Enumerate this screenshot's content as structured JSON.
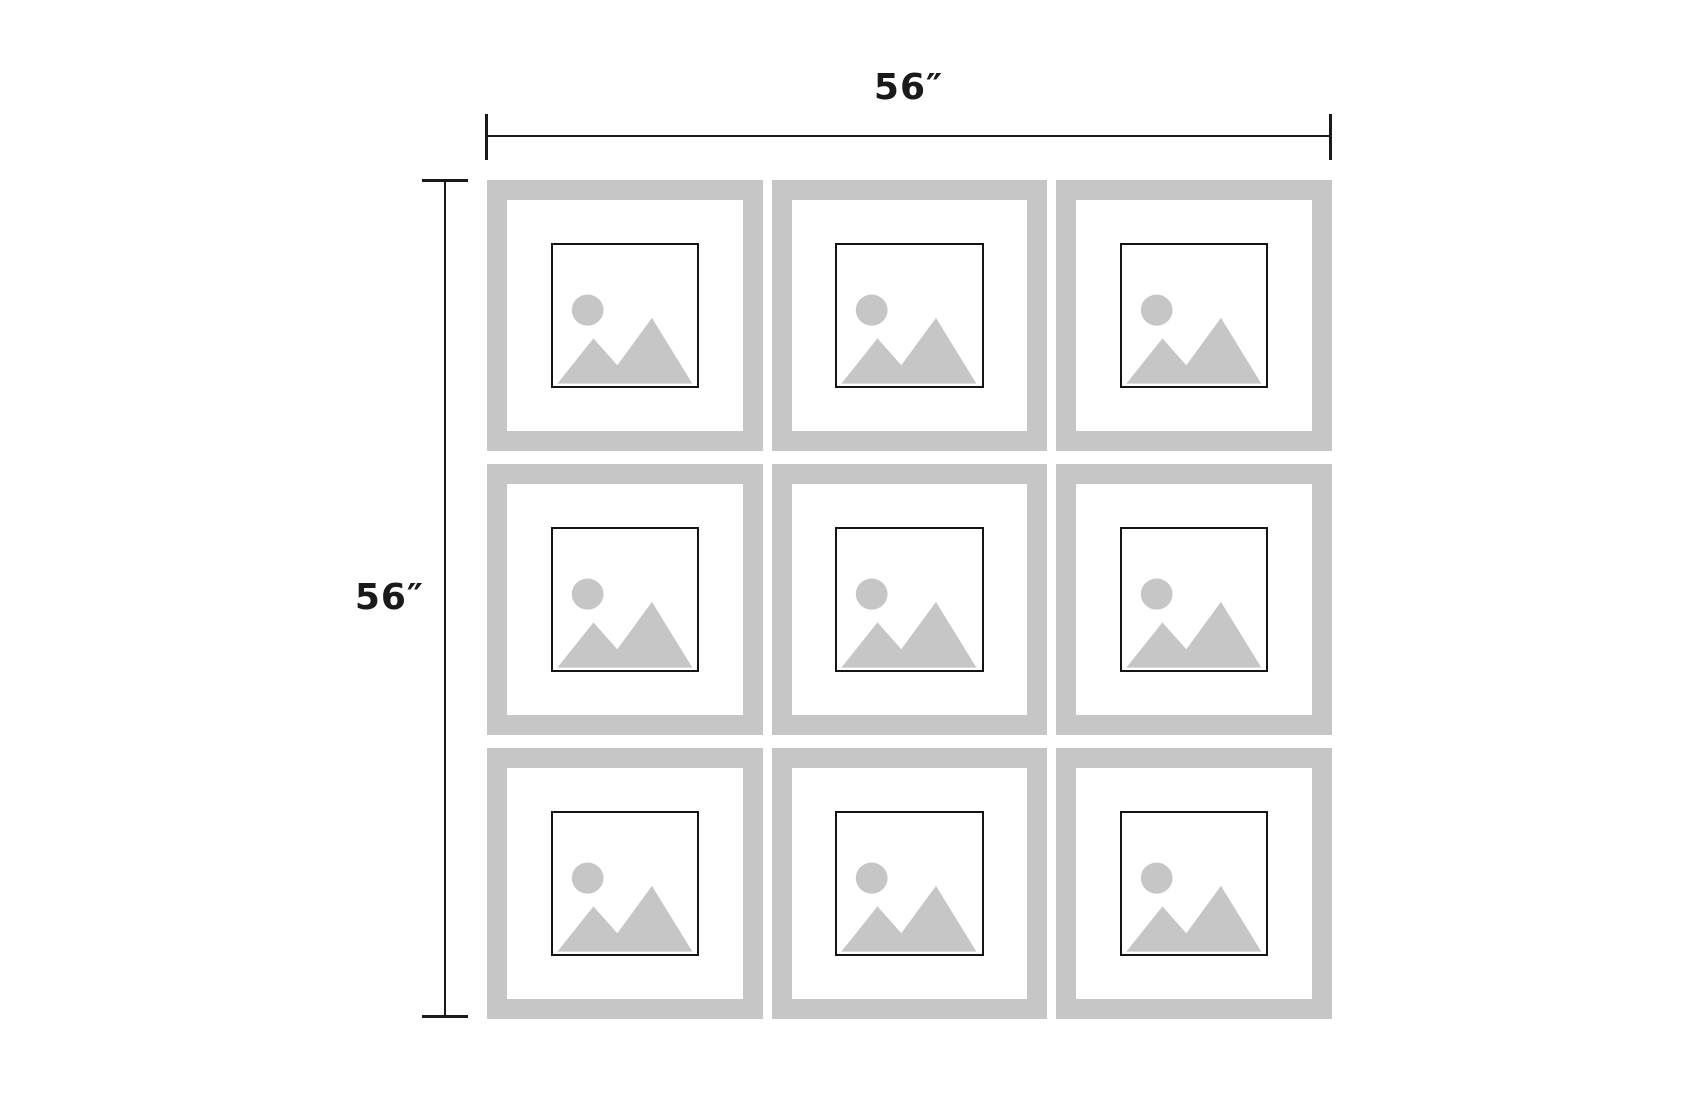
{
  "canvas": {
    "width": 1700,
    "height": 1100,
    "background": "#ffffff"
  },
  "annotations": {
    "width_dimension": {
      "label": "56″"
    },
    "height_dimension": {
      "label": "56″"
    }
  },
  "gallery_wall": {
    "rows": 3,
    "columns": 3,
    "frames": [
      {
        "id": "picture-frame-1"
      },
      {
        "id": "picture-frame-2"
      },
      {
        "id": "picture-frame-3"
      },
      {
        "id": "picture-frame-4"
      },
      {
        "id": "picture-frame-5"
      },
      {
        "id": "picture-frame-6"
      },
      {
        "id": "picture-frame-7"
      },
      {
        "id": "picture-frame-8"
      },
      {
        "id": "picture-frame-9"
      }
    ]
  },
  "colors": {
    "frame": "#c6c6c6",
    "placeholder": "#c6c6c6",
    "dimension_line": "#1a1a1a",
    "photo_border": "#141414"
  }
}
